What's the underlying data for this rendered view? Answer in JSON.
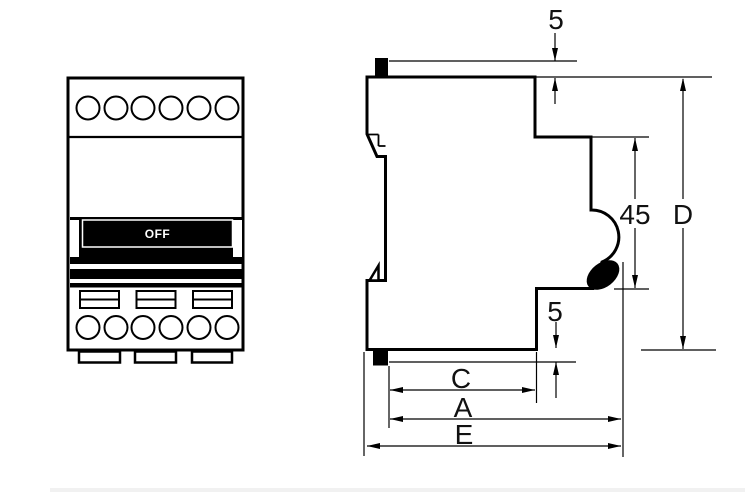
{
  "figure": {
    "title": "Modular circuit breaker outline drawing - front and side views",
    "front_view": {
      "switch_label": "OFF",
      "top_terminal_count": 6,
      "bottom_terminal_count": 6,
      "screw_slot_count": 3,
      "mounting_tab_count": 3
    },
    "side_view": {
      "dimensions": {
        "top_clip_protrusion": "5",
        "recess_height": "45",
        "overall_height": "D",
        "bottom_clip_protrusion": "5",
        "depth_c": "C",
        "depth_a": "A",
        "overall_depth_e": "E"
      }
    },
    "colors": {
      "line": "#000000",
      "background": "#ffffff"
    }
  }
}
